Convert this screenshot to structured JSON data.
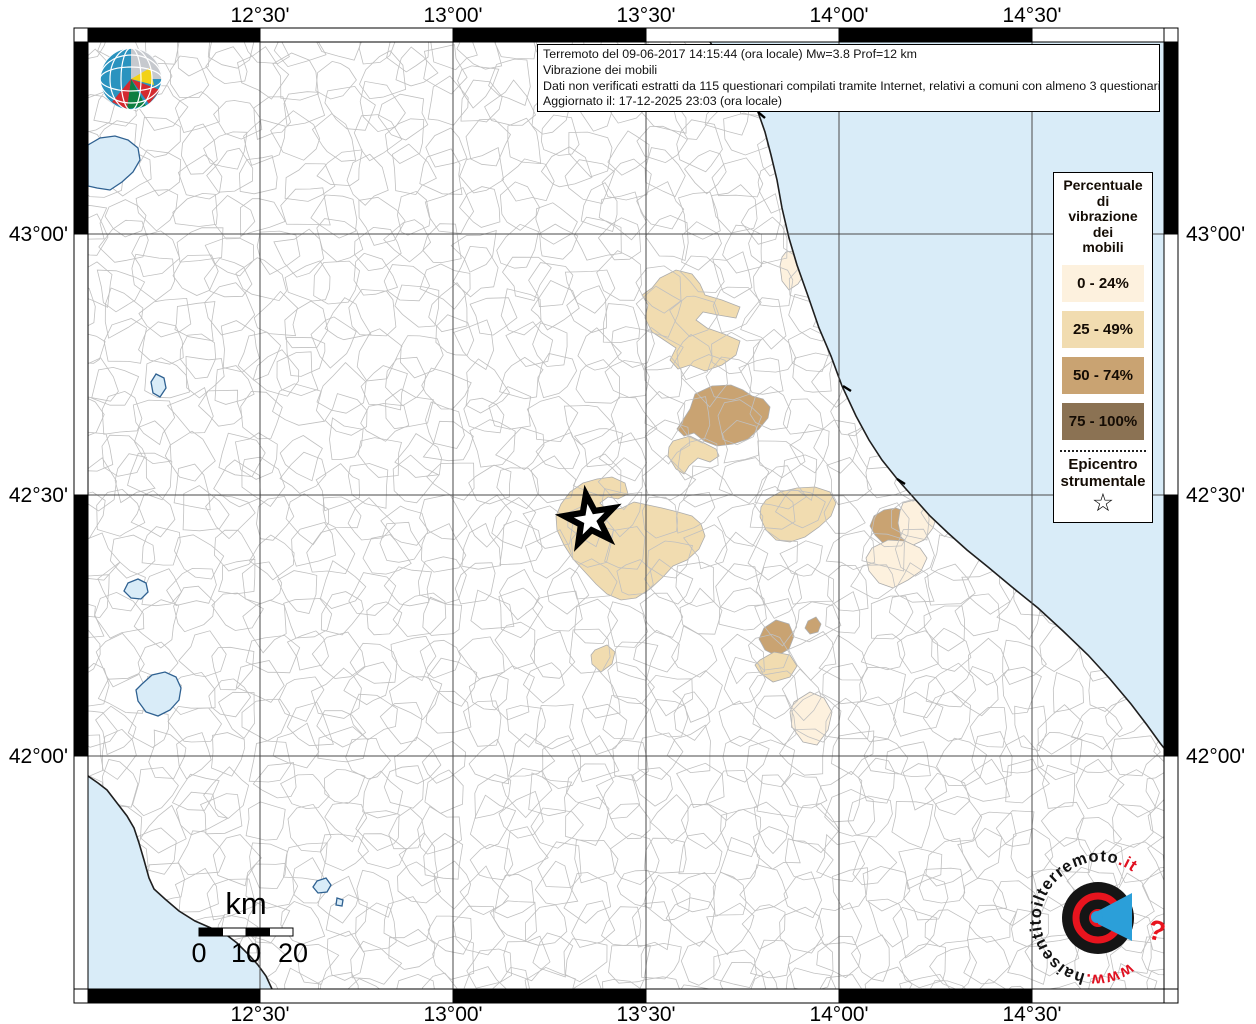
{
  "info_box": {
    "line1": "Terremoto del 09-06-2017 14:15:44 (ora locale) Mw=3.8 Prof=12 km",
    "line2": "Vibrazione dei mobili",
    "line3": "Dati non verificati estratti da 115 questionari compilati tramite Internet, relativi a comuni con almeno 3 questionari.",
    "line4": "Aggiornato il: 17-12-2025 23:03 (ora locale)"
  },
  "ingv_logo": {
    "line1": "ISTITUTO NAZIONALE",
    "line2": "DI GEOFISICA E VULCANOLOGIA"
  },
  "legend": {
    "title_lines": [
      "Percentuale",
      "di",
      "vibrazione",
      "dei",
      "mobili"
    ],
    "classes": [
      {
        "label": "0 - 24%",
        "color": "#fdf1de"
      },
      {
        "label": "25 - 49%",
        "color": "#f1dcb0"
      },
      {
        "label": "50 - 74%",
        "color": "#c9a372"
      },
      {
        "label": "75 - 100%",
        "color": "#8b7253"
      }
    ],
    "epicenter_lines": [
      "Epicentro",
      "strumentale"
    ],
    "star_symbol": "☆"
  },
  "graticule": {
    "lon": [
      {
        "label": "12°30'",
        "x": 260
      },
      {
        "label": "13°00'",
        "x": 453
      },
      {
        "label": "13°30'",
        "x": 646
      },
      {
        "label": "14°00'",
        "x": 839
      },
      {
        "label": "14°30'",
        "x": 1032
      }
    ],
    "lat": [
      {
        "label": "43°00'",
        "y": 234
      },
      {
        "label": "42°30'",
        "y": 495
      },
      {
        "label": "42°00'",
        "y": 756
      }
    ]
  },
  "scalebar": {
    "unit": "km",
    "labels": [
      "0",
      "10",
      "20"
    ],
    "x": 199,
    "y": 928,
    "width": 94,
    "height": 8
  },
  "epicenter": {
    "x": 590,
    "y": 520
  },
  "watermark": {
    "parts": [
      {
        "text": "www.",
        "color": "#e01020"
      },
      {
        "text": "haisentitoilterremoto",
        "color": "#121212"
      },
      {
        "text": ".it",
        "color": "#e01020"
      }
    ],
    "qmark": "?"
  },
  "map": {
    "inner": [
      88,
      42,
      1164,
      989
    ],
    "frame_thickness": 14,
    "colors": {
      "sea": "#d9ecf8",
      "land": "#ffffff",
      "mesh": "#c0c0c0",
      "grid": "#4a4a4a",
      "coast": "#1f1f1f",
      "lake_stroke": "#2f6191",
      "region_stroke": "#adadad"
    },
    "adriatic_coast": [
      [
        710,
        42
      ],
      [
        723,
        62
      ],
      [
        737,
        82
      ],
      [
        750,
        100
      ],
      [
        758,
        112
      ],
      [
        765,
        132
      ],
      [
        771,
        155
      ],
      [
        777,
        180
      ],
      [
        782,
        208
      ],
      [
        789,
        238
      ],
      [
        797,
        265
      ],
      [
        808,
        296
      ],
      [
        819,
        328
      ],
      [
        831,
        356
      ],
      [
        842,
        386
      ],
      [
        856,
        416
      ],
      [
        869,
        440
      ],
      [
        882,
        460
      ],
      [
        898,
        480
      ],
      [
        914,
        498
      ],
      [
        930,
        516
      ],
      [
        948,
        533
      ],
      [
        967,
        550
      ],
      [
        988,
        567
      ],
      [
        1012,
        587
      ],
      [
        1038,
        608
      ],
      [
        1063,
        631
      ],
      [
        1088,
        655
      ],
      [
        1110,
        679
      ],
      [
        1131,
        704
      ],
      [
        1147,
        725
      ],
      [
        1160,
        743
      ],
      [
        1164,
        748
      ]
    ],
    "tyrrhenian_coast": [
      [
        88,
        776
      ],
      [
        98,
        783
      ],
      [
        107,
        790
      ],
      [
        117,
        803
      ],
      [
        127,
        816
      ],
      [
        134,
        828
      ],
      [
        139,
        843
      ],
      [
        144,
        860
      ],
      [
        149,
        878
      ],
      [
        154,
        889
      ],
      [
        165,
        899
      ],
      [
        179,
        911
      ],
      [
        195,
        921
      ],
      [
        211,
        928
      ],
      [
        224,
        933
      ],
      [
        237,
        943
      ],
      [
        249,
        955
      ],
      [
        258,
        965
      ],
      [
        266,
        976
      ],
      [
        272,
        989
      ]
    ],
    "coast_ticks": [
      [
        758,
        112,
        765,
        118
      ],
      [
        843,
        386,
        851,
        391
      ],
      [
        897,
        479,
        905,
        484
      ]
    ],
    "lakes": [
      [
        [
          88,
          186
        ],
        [
          88,
          145
        ],
        [
          100,
          138
        ],
        [
          115,
          136
        ],
        [
          128,
          140
        ],
        [
          138,
          148
        ],
        [
          140,
          160
        ],
        [
          133,
          172
        ],
        [
          122,
          182
        ],
        [
          110,
          190
        ],
        [
          97,
          188
        ]
      ],
      [
        [
          156,
          374
        ],
        [
          164,
          378
        ],
        [
          166,
          388
        ],
        [
          160,
          397
        ],
        [
          153,
          393
        ],
        [
          151,
          382
        ]
      ],
      [
        [
          128,
          583
        ],
        [
          138,
          579
        ],
        [
          146,
          583
        ],
        [
          148,
          592
        ],
        [
          141,
          599
        ],
        [
          131,
          598
        ],
        [
          124,
          591
        ]
      ],
      [
        [
          142,
          684
        ],
        [
          152,
          675
        ],
        [
          165,
          672
        ],
        [
          176,
          677
        ],
        [
          181,
          688
        ],
        [
          179,
          700
        ],
        [
          170,
          710
        ],
        [
          158,
          716
        ],
        [
          146,
          712
        ],
        [
          138,
          701
        ],
        [
          136,
          690
        ]
      ],
      [
        [
          317,
          881
        ],
        [
          326,
          878
        ],
        [
          331,
          885
        ],
        [
          327,
          892
        ],
        [
          318,
          893
        ],
        [
          313,
          887
        ]
      ],
      [
        [
          337,
          898
        ],
        [
          343,
          900
        ],
        [
          342,
          906
        ],
        [
          336,
          905
        ]
      ]
    ],
    "felt_regions": [
      {
        "cls": 0,
        "points": [
          [
            786,
            252
          ],
          [
            800,
            250
          ],
          [
            808,
            258
          ],
          [
            806,
            272
          ],
          [
            798,
            284
          ],
          [
            789,
            290
          ],
          [
            782,
            281
          ],
          [
            780,
            266
          ],
          [
            782,
            257
          ]
        ]
      },
      {
        "cls": 1,
        "points": [
          [
            660,
            278
          ],
          [
            676,
            270
          ],
          [
            692,
            274
          ],
          [
            700,
            284
          ],
          [
            705,
            295
          ],
          [
            722,
            300
          ],
          [
            740,
            307
          ],
          [
            736,
            318
          ],
          [
            718,
            315
          ],
          [
            703,
            312
          ],
          [
            696,
            320
          ],
          [
            707,
            328
          ],
          [
            724,
            334
          ],
          [
            740,
            341
          ],
          [
            736,
            355
          ],
          [
            722,
            365
          ],
          [
            705,
            371
          ],
          [
            690,
            365
          ],
          [
            678,
            369
          ],
          [
            670,
            360
          ],
          [
            676,
            348
          ],
          [
            664,
            340
          ],
          [
            652,
            332
          ],
          [
            645,
            318
          ],
          [
            648,
            305
          ],
          [
            642,
            295
          ],
          [
            652,
            288
          ]
        ]
      },
      {
        "cls": 2,
        "points": [
          [
            695,
            394
          ],
          [
            712,
            386
          ],
          [
            731,
            385
          ],
          [
            743,
            390
          ],
          [
            752,
            396
          ],
          [
            763,
            399
          ],
          [
            770,
            407
          ],
          [
            768,
            418
          ],
          [
            759,
            429
          ],
          [
            748,
            439
          ],
          [
            733,
            444
          ],
          [
            717,
            446
          ],
          [
            704,
            441
          ],
          [
            694,
            433
          ],
          [
            684,
            436
          ],
          [
            677,
            429
          ],
          [
            683,
            420
          ],
          [
            690,
            409
          ]
        ]
      },
      {
        "cls": 1,
        "points": [
          [
            673,
            441
          ],
          [
            690,
            436
          ],
          [
            704,
            443
          ],
          [
            716,
            449
          ],
          [
            719,
            456
          ],
          [
            710,
            462
          ],
          [
            698,
            458
          ],
          [
            689,
            466
          ],
          [
            684,
            474
          ],
          [
            676,
            469
          ],
          [
            668,
            456
          ],
          [
            669,
            447
          ]
        ]
      },
      {
        "cls": 1,
        "points": [
          [
            561,
            504
          ],
          [
            570,
            492
          ],
          [
            583,
            483
          ],
          [
            597,
            479
          ],
          [
            612,
            477
          ],
          [
            625,
            483
          ],
          [
            628,
            494
          ],
          [
            618,
            499
          ],
          [
            608,
            497
          ],
          [
            600,
            503
          ],
          [
            608,
            511
          ],
          [
            622,
            508
          ],
          [
            634,
            502
          ],
          [
            648,
            505
          ],
          [
            662,
            508
          ],
          [
            678,
            512
          ],
          [
            692,
            516
          ],
          [
            701,
            524
          ],
          [
            705,
            536
          ],
          [
            699,
            549
          ],
          [
            687,
            560
          ],
          [
            673,
            566
          ],
          [
            663,
            577
          ],
          [
            650,
            589
          ],
          [
            636,
            598
          ],
          [
            621,
            600
          ],
          [
            607,
            594
          ],
          [
            596,
            584
          ],
          [
            585,
            572
          ],
          [
            573,
            559
          ],
          [
            564,
            545
          ],
          [
            557,
            530
          ],
          [
            556,
            516
          ]
        ]
      },
      {
        "cls": 1,
        "points": [
          [
            595,
            650
          ],
          [
            607,
            645
          ],
          [
            615,
            652
          ],
          [
            612,
            664
          ],
          [
            601,
            672
          ],
          [
            592,
            664
          ],
          [
            591,
            655
          ]
        ]
      },
      {
        "cls": 1,
        "points": [
          [
            766,
            500
          ],
          [
            780,
            492
          ],
          [
            797,
            488
          ],
          [
            815,
            487
          ],
          [
            830,
            492
          ],
          [
            836,
            503
          ],
          [
            831,
            516
          ],
          [
            819,
            527
          ],
          [
            805,
            537
          ],
          [
            790,
            542
          ],
          [
            776,
            540
          ],
          [
            766,
            530
          ],
          [
            760,
            517
          ],
          [
            761,
            507
          ]
        ]
      },
      {
        "cls": 2,
        "points": [
          [
            874,
            516
          ],
          [
            884,
            510
          ],
          [
            896,
            508
          ],
          [
            906,
            512
          ],
          [
            912,
            520
          ],
          [
            913,
            530
          ],
          [
            906,
            540
          ],
          [
            895,
            546
          ],
          [
            883,
            543
          ],
          [
            875,
            535
          ],
          [
            870,
            526
          ]
        ]
      },
      {
        "cls": 0,
        "points": [
          [
            903,
            503
          ],
          [
            918,
            499
          ],
          [
            931,
            505
          ],
          [
            937,
            515
          ],
          [
            933,
            528
          ],
          [
            924,
            540
          ],
          [
            911,
            546
          ],
          [
            901,
            537
          ],
          [
            898,
            523
          ],
          [
            900,
            511
          ]
        ]
      },
      {
        "cls": 0,
        "points": [
          [
            872,
            548
          ],
          [
            888,
            540
          ],
          [
            905,
            541
          ],
          [
            920,
            548
          ],
          [
            927,
            558
          ],
          [
            921,
            571
          ],
          [
            908,
            580
          ],
          [
            893,
            588
          ],
          [
            879,
            583
          ],
          [
            869,
            571
          ],
          [
            866,
            558
          ]
        ]
      },
      {
        "cls": 2,
        "points": [
          [
            764,
            628
          ],
          [
            776,
            620
          ],
          [
            789,
            624
          ],
          [
            794,
            636
          ],
          [
            789,
            649
          ],
          [
            777,
            656
          ],
          [
            765,
            650
          ],
          [
            759,
            639
          ]
        ]
      },
      {
        "cls": 2,
        "points": [
          [
            808,
            621
          ],
          [
            816,
            617
          ],
          [
            821,
            624
          ],
          [
            818,
            632
          ],
          [
            810,
            634
          ],
          [
            805,
            628
          ]
        ]
      },
      {
        "cls": 1,
        "points": [
          [
            760,
            660
          ],
          [
            774,
            652
          ],
          [
            790,
            655
          ],
          [
            797,
            666
          ],
          [
            790,
            677
          ],
          [
            773,
            682
          ],
          [
            760,
            673
          ],
          [
            755,
            665
          ]
        ]
      },
      {
        "cls": 0,
        "points": [
          [
            794,
            702
          ],
          [
            810,
            692
          ],
          [
            824,
            698
          ],
          [
            832,
            712
          ],
          [
            828,
            730
          ],
          [
            817,
            745
          ],
          [
            803,
            742
          ],
          [
            792,
            727
          ],
          [
            790,
            712
          ]
        ]
      }
    ]
  }
}
